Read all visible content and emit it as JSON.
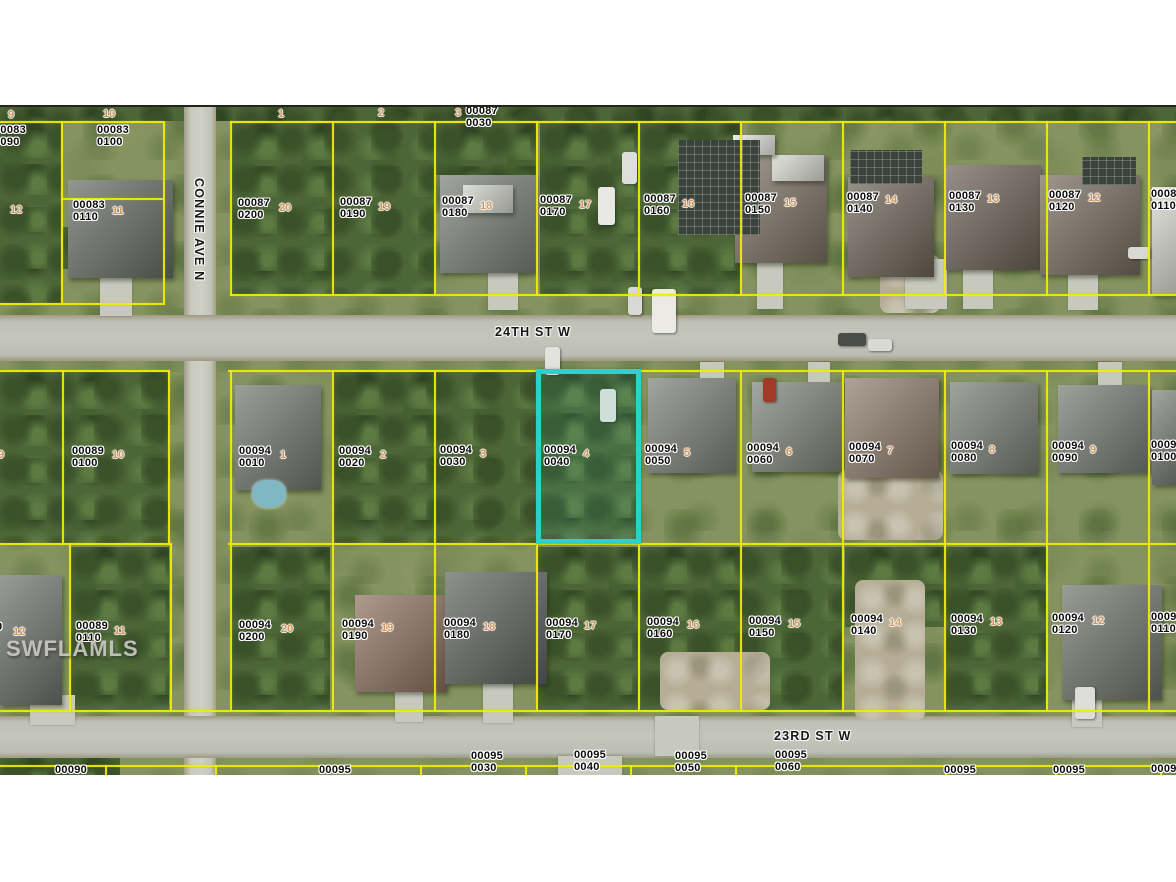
{
  "watermark": "SWFLAMLS",
  "colors": {
    "parcel_line": "#f1ee02",
    "highlight_border": "#2ad2ca",
    "label_text": "#0b0b0b",
    "lot_marker": "#d8995a"
  },
  "highlighted_parcel": {
    "id": "00094 0040",
    "lot": "4"
  },
  "streets": [
    {
      "name": "24TH ST W",
      "x": 495,
      "y": 325,
      "vertical": false
    },
    {
      "name": "23RD ST W",
      "x": 774,
      "y": 729,
      "vertical": false
    },
    {
      "name": "CONNIE AVE N",
      "x": 206,
      "y": 178,
      "vertical": true
    }
  ],
  "parcel_labels": [
    {
      "t": "00083\n0090",
      "x": -6,
      "y": 125
    },
    {
      "t": "00083\n0100",
      "x": 97,
      "y": 125
    },
    {
      "t": "00083\n0110",
      "x": 73,
      "y": 200
    },
    {
      "t": "00087\n0030",
      "x": 466,
      "y": 106
    },
    {
      "t": "00087\n0200",
      "x": 238,
      "y": 198
    },
    {
      "t": "00087\n0190",
      "x": 340,
      "y": 197
    },
    {
      "t": "00087\n0180",
      "x": 442,
      "y": 196
    },
    {
      "t": "00087\n0170",
      "x": 540,
      "y": 195
    },
    {
      "t": "00087\n0160",
      "x": 644,
      "y": 194
    },
    {
      "t": "00087\n0150",
      "x": 745,
      "y": 193
    },
    {
      "t": "00087\n0140",
      "x": 847,
      "y": 192
    },
    {
      "t": "00087\n0130",
      "x": 949,
      "y": 191
    },
    {
      "t": "00087\n0120",
      "x": 1049,
      "y": 190
    },
    {
      "t": "00087\n0110",
      "x": 1151,
      "y": 189
    },
    {
      "t": "00089\n0100",
      "x": 72,
      "y": 446
    },
    {
      "t": "00094\n0010",
      "x": 239,
      "y": 446
    },
    {
      "t": "00094\n0020",
      "x": 339,
      "y": 446
    },
    {
      "t": "00094\n0030",
      "x": 440,
      "y": 445
    },
    {
      "t": "00094\n0040",
      "x": 544,
      "y": 445
    },
    {
      "t": "00094\n0050",
      "x": 645,
      "y": 444
    },
    {
      "t": "00094\n0060",
      "x": 747,
      "y": 443
    },
    {
      "t": "00094\n0070",
      "x": 849,
      "y": 442
    },
    {
      "t": "00094\n0080",
      "x": 951,
      "y": 441
    },
    {
      "t": "00094\n0090",
      "x": 1052,
      "y": 441
    },
    {
      "t": "00094\n0100",
      "x": 1151,
      "y": 440
    },
    {
      "t": "9",
      "x": -4,
      "y": 622
    },
    {
      "t": "00089\n0110",
      "x": 76,
      "y": 621
    },
    {
      "t": "00094\n0200",
      "x": 239,
      "y": 620
    },
    {
      "t": "00094\n0190",
      "x": 342,
      "y": 619
    },
    {
      "t": "00094\n0180",
      "x": 444,
      "y": 618
    },
    {
      "t": "00094\n0170",
      "x": 546,
      "y": 618
    },
    {
      "t": "00094\n0160",
      "x": 647,
      "y": 617
    },
    {
      "t": "00094\n0150",
      "x": 749,
      "y": 616
    },
    {
      "t": "00094\n0140",
      "x": 851,
      "y": 614
    },
    {
      "t": "00094\n0130",
      "x": 951,
      "y": 614
    },
    {
      "t": "00094\n0120",
      "x": 1052,
      "y": 613
    },
    {
      "t": "00094\n0110",
      "x": 1151,
      "y": 612
    },
    {
      "t": "00090",
      "x": 55,
      "y": 765
    },
    {
      "t": "00095",
      "x": 319,
      "y": 765
    },
    {
      "t": "00095\n0030",
      "x": 471,
      "y": 751
    },
    {
      "t": "00095\n0040",
      "x": 574,
      "y": 750
    },
    {
      "t": "00095\n0050",
      "x": 675,
      "y": 751
    },
    {
      "t": "00095\n0060",
      "x": 775,
      "y": 750
    },
    {
      "t": "00095",
      "x": 944,
      "y": 765
    },
    {
      "t": "00095",
      "x": 1053,
      "y": 765
    },
    {
      "t": "0009",
      "x": 1151,
      "y": 764
    }
  ],
  "lot_markers": [
    {
      "n": "9",
      "x": 8,
      "y": 110
    },
    {
      "n": "10",
      "x": 103,
      "y": 109
    },
    {
      "n": "12",
      "x": 10,
      "y": 205
    },
    {
      "n": "11",
      "x": 112,
      "y": 206
    },
    {
      "n": "1",
      "x": 278,
      "y": 109
    },
    {
      "n": "2",
      "x": 378,
      "y": 108
    },
    {
      "n": "3",
      "x": 455,
      "y": 108
    },
    {
      "n": "20",
      "x": 279,
      "y": 203
    },
    {
      "n": "19",
      "x": 378,
      "y": 202
    },
    {
      "n": "18",
      "x": 480,
      "y": 201
    },
    {
      "n": "17",
      "x": 579,
      "y": 200
    },
    {
      "n": "16",
      "x": 682,
      "y": 199
    },
    {
      "n": "15",
      "x": 784,
      "y": 198
    },
    {
      "n": "14",
      "x": 885,
      "y": 195
    },
    {
      "n": "13",
      "x": 987,
      "y": 194
    },
    {
      "n": "12",
      "x": 1088,
      "y": 193
    },
    {
      "n": "9",
      "x": -2,
      "y": 450
    },
    {
      "n": "10",
      "x": 112,
      "y": 450
    },
    {
      "n": "1",
      "x": 280,
      "y": 450
    },
    {
      "n": "2",
      "x": 380,
      "y": 450
    },
    {
      "n": "3",
      "x": 480,
      "y": 449
    },
    {
      "n": "4",
      "x": 583,
      "y": 449
    },
    {
      "n": "5",
      "x": 684,
      "y": 448
    },
    {
      "n": "6",
      "x": 786,
      "y": 447
    },
    {
      "n": "7",
      "x": 887,
      "y": 446
    },
    {
      "n": "8",
      "x": 989,
      "y": 445
    },
    {
      "n": "9",
      "x": 1090,
      "y": 445
    },
    {
      "n": "12",
      "x": 13,
      "y": 627
    },
    {
      "n": "11",
      "x": 114,
      "y": 626
    },
    {
      "n": "20",
      "x": 281,
      "y": 624
    },
    {
      "n": "19",
      "x": 381,
      "y": 623
    },
    {
      "n": "18",
      "x": 483,
      "y": 622
    },
    {
      "n": "17",
      "x": 584,
      "y": 621
    },
    {
      "n": "16",
      "x": 687,
      "y": 620
    },
    {
      "n": "15",
      "x": 788,
      "y": 619
    },
    {
      "n": "14",
      "x": 889,
      "y": 618
    },
    {
      "n": "13",
      "x": 990,
      "y": 617
    },
    {
      "n": "12",
      "x": 1092,
      "y": 616
    }
  ]
}
